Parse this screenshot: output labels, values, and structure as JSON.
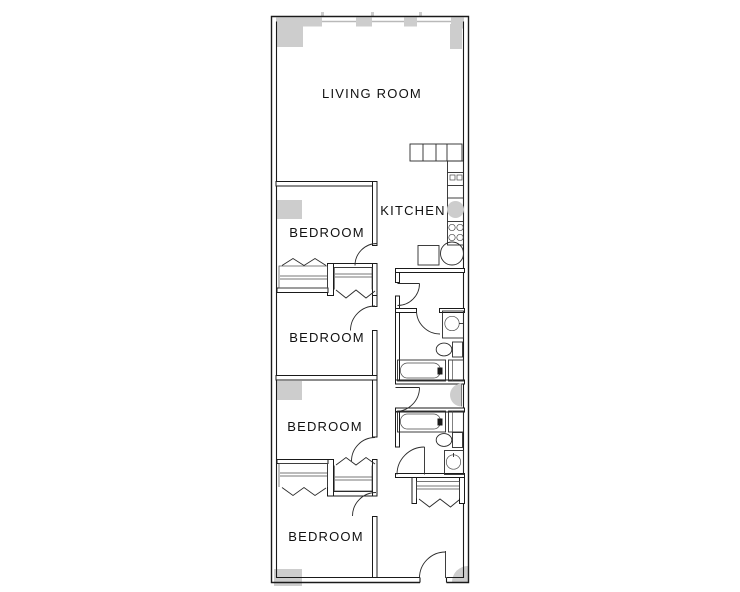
{
  "document": {
    "type": "architectural-floor-plan",
    "description": "Long narrow apartment unit floor plan, black line work on white with gray structural columns"
  },
  "colors": {
    "line": "#1a1a1a",
    "column_gray": "#cdcdcd",
    "glazing_gray": "#b9b9b9",
    "background": "#ffffff",
    "text": "#111111"
  },
  "rooms": [
    {
      "id": "living-room",
      "label": "LIVING ROOM"
    },
    {
      "id": "kitchen",
      "label": "KITCHEN"
    },
    {
      "id": "bedroom-1",
      "label": "BEDROOM"
    },
    {
      "id": "bedroom-2",
      "label": "BEDROOM"
    },
    {
      "id": "bedroom-3",
      "label": "BEDROOM"
    },
    {
      "id": "bedroom-4",
      "label": "BEDROOM"
    }
  ],
  "symbols": {
    "kitchen": [
      "counter-cabinets",
      "dishwasher",
      "round-sink",
      "four-burner-range",
      "corner-cabinet"
    ],
    "bathroom": [
      "vanity-sink",
      "toilet",
      "bathtub",
      "tub-side-cabinet"
    ],
    "closet": [
      "bifold-door-chevrons",
      "hanging-rod"
    ],
    "doors": [
      "swing-door-arc",
      "entry-door"
    ],
    "structure": [
      "window-wall-mullions",
      "concrete-columns"
    ]
  }
}
